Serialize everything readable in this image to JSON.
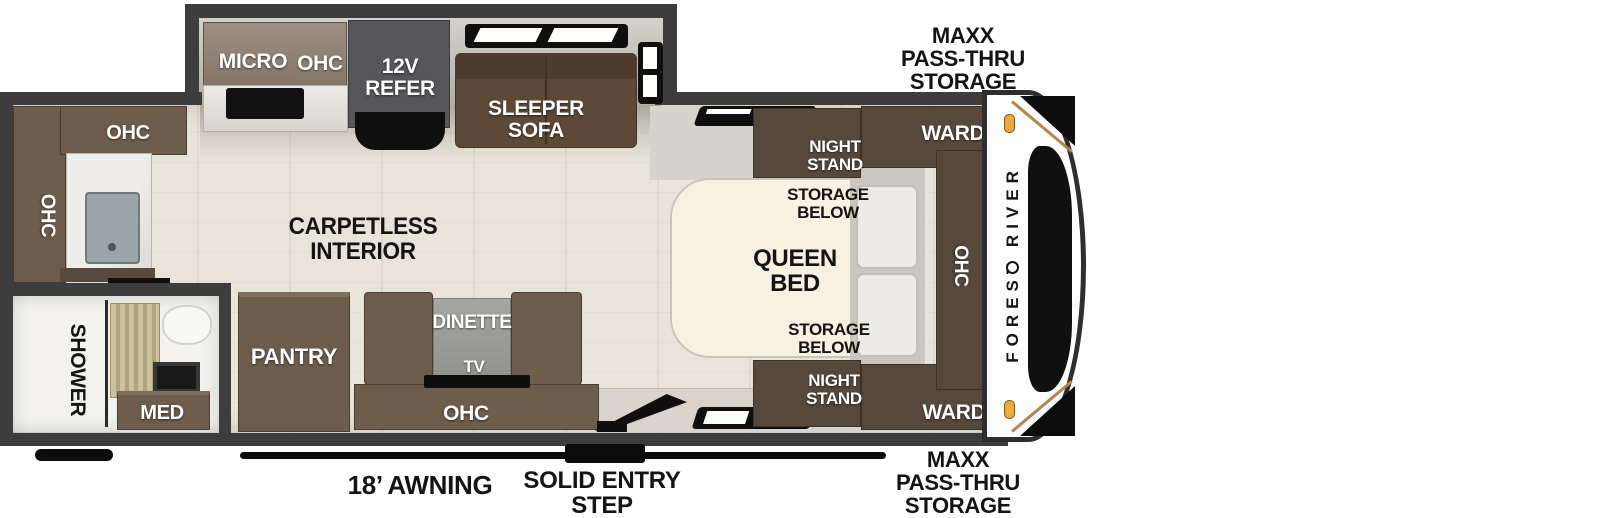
{
  "colors": {
    "wall": "#3d3d3d",
    "floor": "#e9e4d9",
    "slide_floor": "#c9c6c0",
    "cabinet_brown": "#6e5c4c",
    "cabinet_dark_brown": "#57483c",
    "cabinet_taupe": "#8d7e72",
    "sofa_brown": "#5d4938",
    "refer_gray": "#57575a",
    "bed_cream": "#f6f1e1",
    "dinette_table_gray": "#9c9c98",
    "bath_accent_tan": "#c2b694",
    "marker_light_orange": "#eda83f",
    "label_white": "#ffffff",
    "label_black": "#141414"
  },
  "exterior": {
    "brand": "FOREST RIVER",
    "front_storage_top": "MAXX\nPASS-THRU\nSTORAGE",
    "front_storage_bottom": "MAXX\nPASS-THRU\nSTORAGE",
    "awning": "18’ AWNING",
    "entry_step": "SOLID ENTRY\nSTEP"
  },
  "kitchen": {
    "micro": "MICRO",
    "ohc": "OHC",
    "refer": "12V\nREFER",
    "sleeper_sofa": "SLEEPER\nSOFA"
  },
  "rear": {
    "ohc_top": "OHC",
    "ohc_side": "OHC"
  },
  "bath": {
    "shower": "SHOWER",
    "med": "MED"
  },
  "living": {
    "carpetless": "CARPETLESS\nINTERIOR",
    "pantry": "PANTRY",
    "dinette": "DINETTE",
    "tv": "TV",
    "ohc": "OHC"
  },
  "bedroom": {
    "night_stand_top": "NIGHT\nSTAND",
    "storage_below_top": "STORAGE\nBELOW",
    "queen_bed": "QUEEN\nBED",
    "storage_below_bottom": "STORAGE\nBELOW",
    "night_stand_bottom": "NIGHT\nSTAND",
    "ward_top": "WARD",
    "ward_bottom": "WARD",
    "ohc": "OHC"
  }
}
